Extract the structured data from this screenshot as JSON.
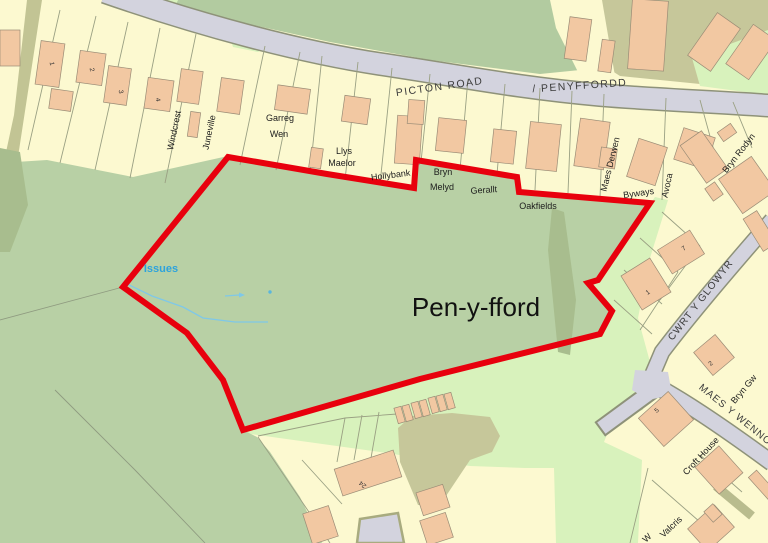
{
  "labels": {
    "picton_road": "PICTON ROAD",
    "penyffordd": "/ PENYFFORDD",
    "cwrt_y_glowyr": "CWRT Y GLOWYR",
    "maes_y_wennol": "MAES Y WENNOL",
    "site": "Pen-y-fford",
    "issues": "Issues",
    "windcrest": "Windcrest",
    "juneville": "Juneville",
    "garreg": "Garreg",
    "wen": "Wen",
    "llys": "Llys",
    "maelor": "Maelor",
    "hollybank": "Hollybank",
    "bryn": "Bryn",
    "melyd": "Melyd",
    "gerallt": "Gerallt",
    "oakfields": "Oakfields",
    "maes_derwen": "Maes Derwen",
    "byways": "Byways",
    "avoca": "Avoca",
    "bryn_rodyn": "Bryn Rodyn",
    "bryn_gw": "Bryn Gw",
    "croft_house": "Croft House",
    "valcris": "Valcris",
    "w_partial": "W",
    "num_1": "1",
    "num_2": "2",
    "num_3": "3",
    "num_4": "4",
    "num_24": "24",
    "num_7": "7",
    "num_1b": "1",
    "num_2b": "2",
    "num_5": "5"
  },
  "colors": {
    "boundary_red": "#e8000d",
    "field_green": "#b8d0a5",
    "light_green": "#d8f2bc",
    "plot_yellow": "#fcf9d0",
    "building_peach": "#f2c8a2",
    "olive": "#c6c79a",
    "hedge_olive": "#aebd90",
    "road_gray": "#d3d3de",
    "road_casing": "#8e9279",
    "water_blue": "#2da3dc",
    "stream_blue": "#7fc8e8"
  }
}
